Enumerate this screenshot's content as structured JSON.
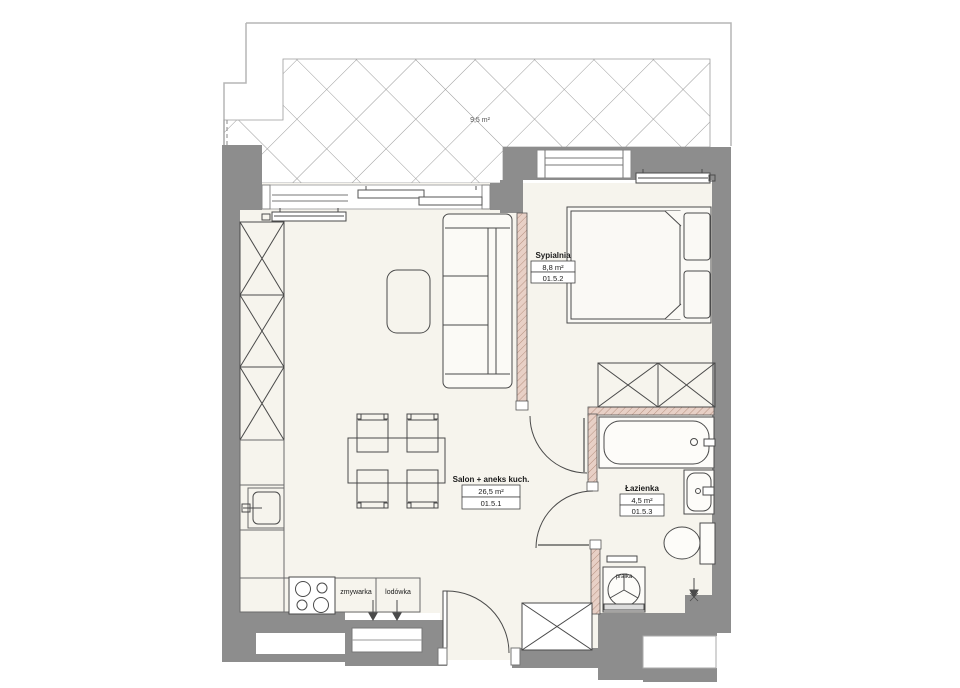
{
  "plan": {
    "title": "apartment-floor-plan",
    "terrace": {
      "area": "9,5 m²"
    },
    "rooms": [
      {
        "id": "salon",
        "name": "Salon + aneks kuch.",
        "area": "26,5 m²",
        "number": "01.5.1"
      },
      {
        "id": "sypialnia",
        "name": "Sypialnia",
        "area": "8,8 m²",
        "number": "01.5.2"
      },
      {
        "id": "lazienka",
        "name": "Łazienka",
        "area": "4,5 m²",
        "number": "01.5.3"
      }
    ],
    "appliances": {
      "dishwasher": "zmywarka",
      "fridge": "lodówka",
      "washer": "pralka"
    },
    "icons": [
      "bed-icon",
      "wardrobe-icon",
      "sofa-icon",
      "coffee-table-icon",
      "dining-table-icon",
      "chair-icon",
      "kitchen-cabinet-icon",
      "sink-icon",
      "hob-icon",
      "radiator-icon",
      "bathtub-icon",
      "washbasin-icon",
      "toilet-icon",
      "washing-machine-icon",
      "shaft-icon",
      "door-swing-icon",
      "window-icon",
      "drain-arrow-icon"
    ],
    "colors": {
      "wall": "#8d8d8d",
      "partition_fill": "#e8d0c6",
      "partition_hatch": "#b5907f",
      "floor": "#f6f4ed",
      "terrace_hatch": "#9b9b9b",
      "outline": "#4a4a4a"
    }
  }
}
